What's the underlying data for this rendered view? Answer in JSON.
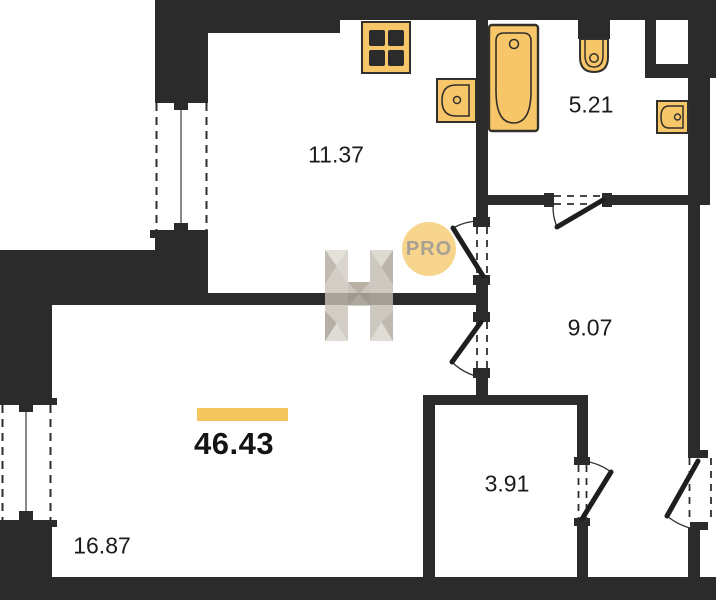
{
  "floorplan": {
    "total_area": "46.43",
    "rooms": [
      {
        "id": "kitchen",
        "area": "11.37"
      },
      {
        "id": "bathroom",
        "area": "5.21"
      },
      {
        "id": "hallway",
        "area": "9.07"
      },
      {
        "id": "storage",
        "area": "3.91"
      },
      {
        "id": "living-room",
        "area": "16.87"
      }
    ],
    "watermark": {
      "badge": "PRO"
    },
    "colors": {
      "wall": "#2b2b2b",
      "fixture_fill": "#f6c669",
      "fixture_border": "#332f2a",
      "accent_bar": "#f5c55e",
      "badge_bg": "#f7d182",
      "badge_text": "#a8a094",
      "label_text": "#1b1b19",
      "watermark_gray": "#c6c0b5"
    }
  }
}
